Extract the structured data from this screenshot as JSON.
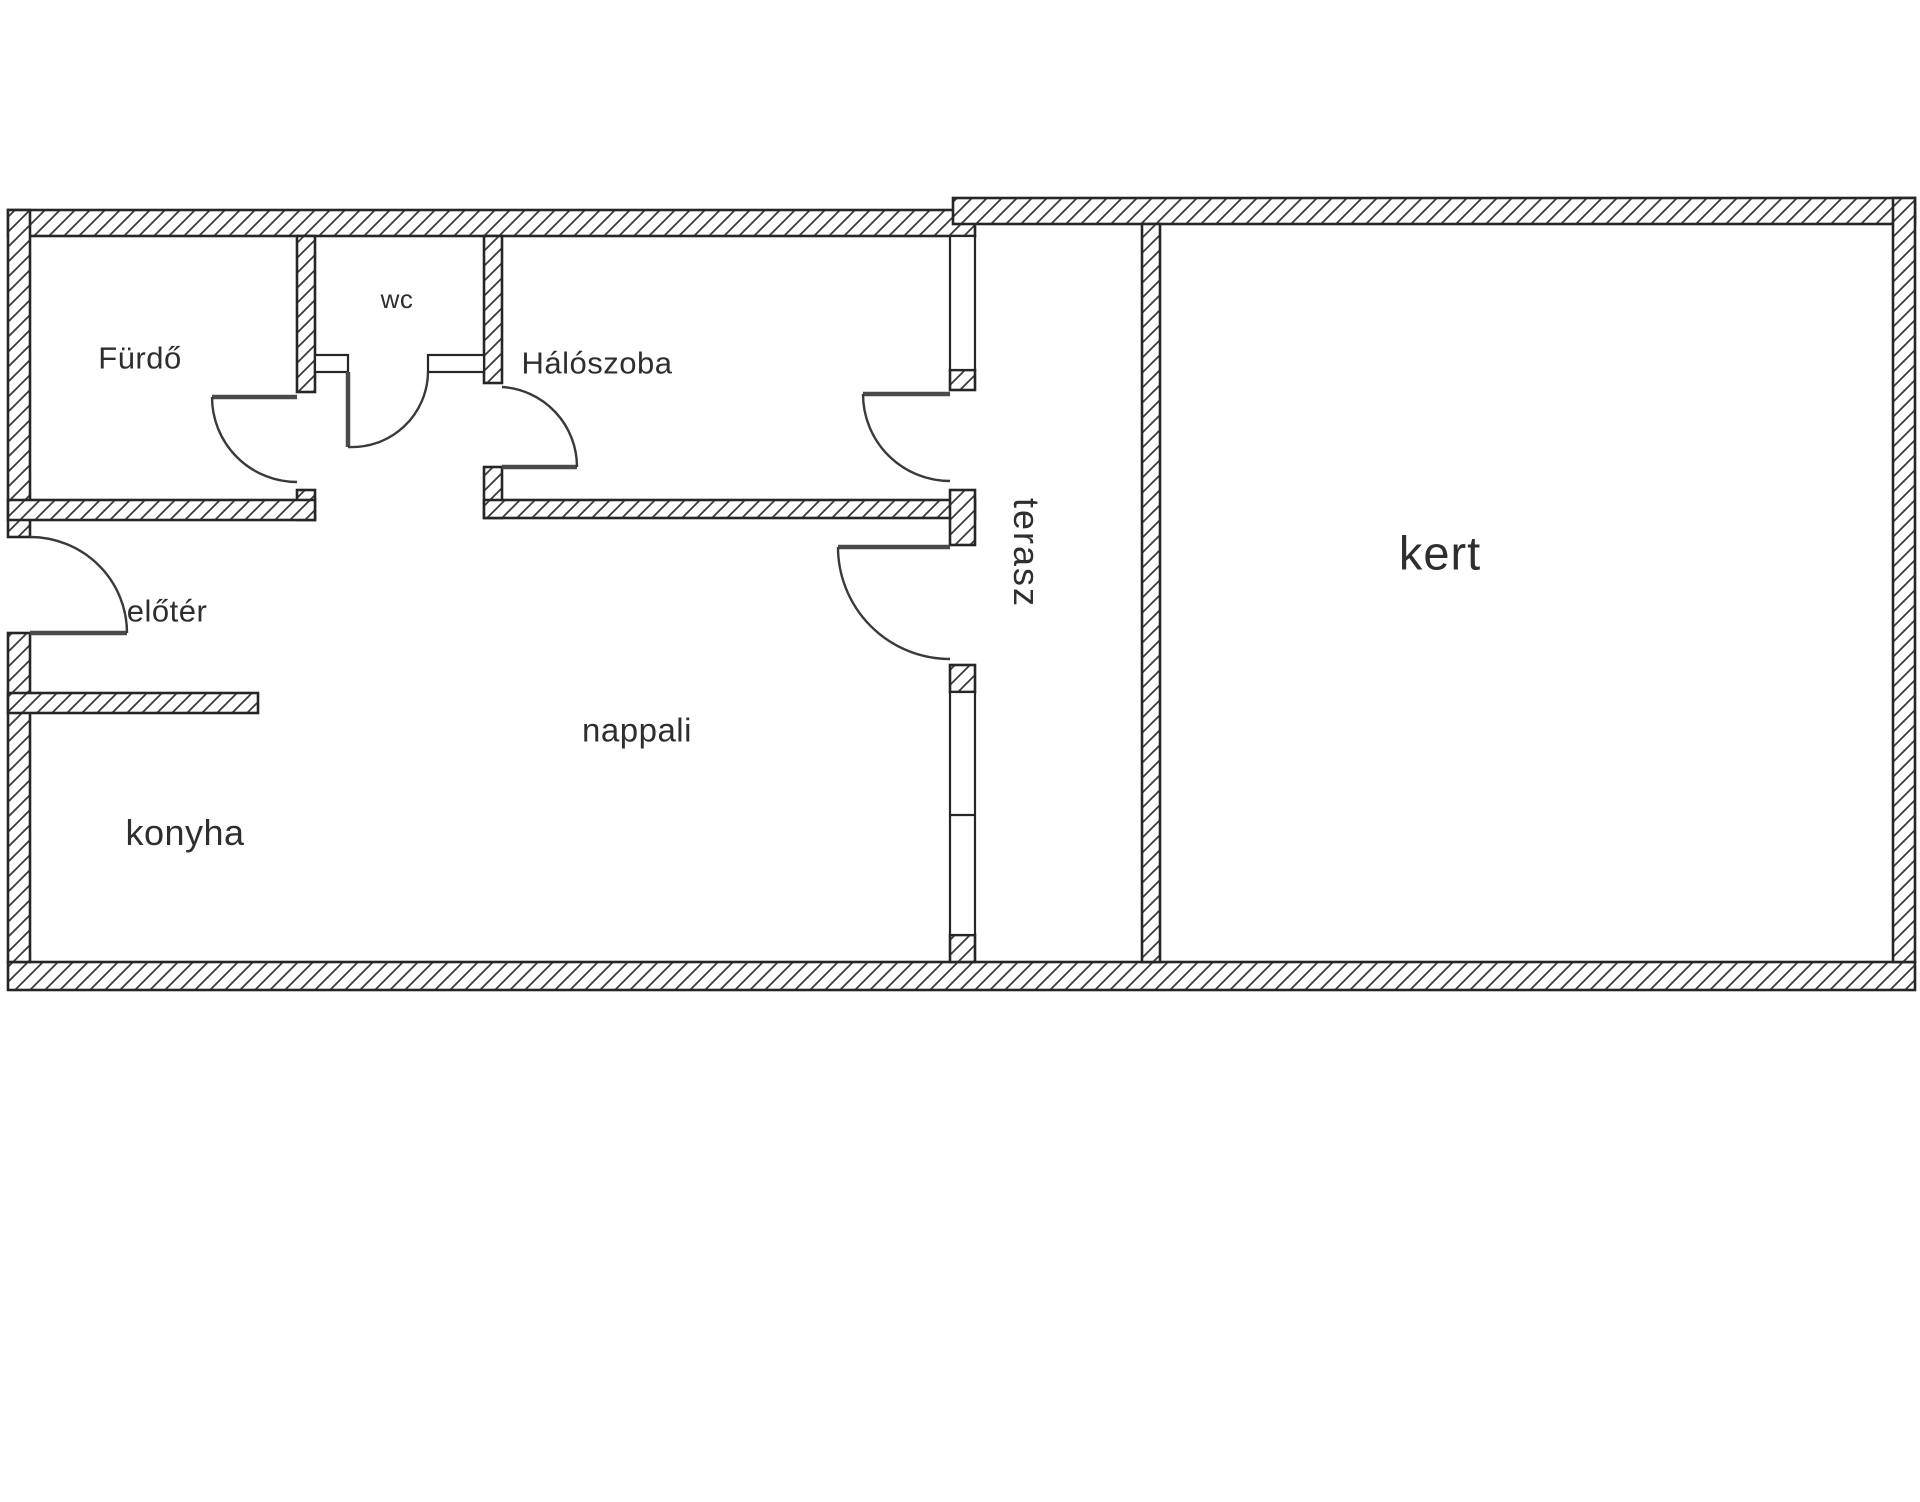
{
  "plan": {
    "type": "apartment-floor-plan",
    "background_color": "#ffffff",
    "wall_line_color": "#262626",
    "hatch_color": "#3a3a3a",
    "label_color": "#2e2e2e",
    "rooms": {
      "bathroom": {
        "label": "Fürdő"
      },
      "wc": {
        "label": "wc"
      },
      "bedroom": {
        "label": "Hálószoba"
      },
      "foyer": {
        "label": "előtér"
      },
      "living_room": {
        "label": "nappali"
      },
      "kitchen": {
        "label": "konyha"
      },
      "terrace": {
        "label": "terasz"
      },
      "garden": {
        "label": "kert"
      }
    }
  }
}
